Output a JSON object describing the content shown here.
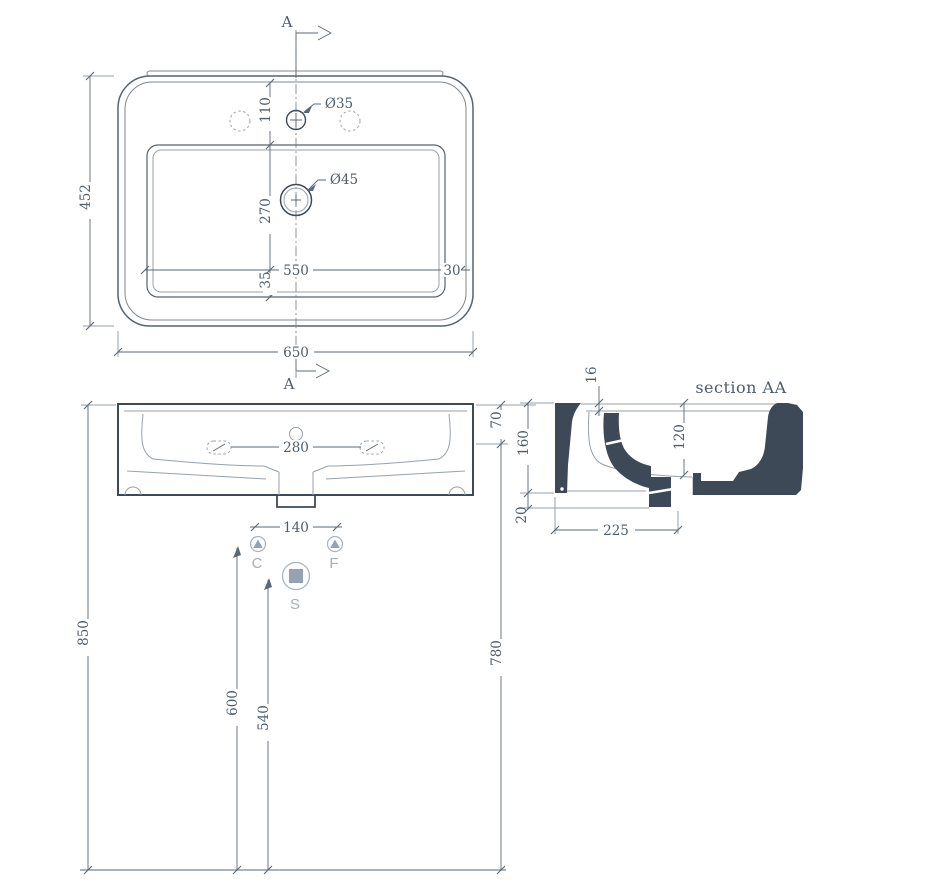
{
  "plan": {
    "section_label_top": "A",
    "section_label_bottom": "A",
    "dim_overall_depth": "452",
    "dim_overall_width": "650",
    "dim_basin_width": "550",
    "dim_side_margin": "30",
    "dim_faucet_offset": "110",
    "dim_drain_offset": "270",
    "dim_front_margin": "35",
    "label_faucet_hole": "Ø35",
    "label_drain_hole": "Ø45"
  },
  "front": {
    "dim_side_holes_spacing": "280",
    "dim_drain_stub_width": "140",
    "dim_rim_drop": "70",
    "dim_height_to_top": "850",
    "dim_height_under_rim": "780",
    "dim_cold_feed_height": "600",
    "dim_trap_height": "540",
    "label_cold": "C",
    "label_hot": "F",
    "label_waste": "S"
  },
  "section": {
    "title": "section AA",
    "dim_rim_thickness": "16",
    "dim_basin_depth": "120",
    "dim_body_height": "160",
    "dim_stub_drop": "20",
    "dim_base_width": "225"
  },
  "colors": {
    "line": "#56636e",
    "dark_fill": "#3d4956",
    "light_line": "#96a1ac",
    "dashed": "#9aa5af",
    "fixture_symbol": "#97a2b0",
    "fixture_label": "#a5afb9",
    "dimension_text": "#4e5d6b",
    "background": "#ffffff"
  }
}
